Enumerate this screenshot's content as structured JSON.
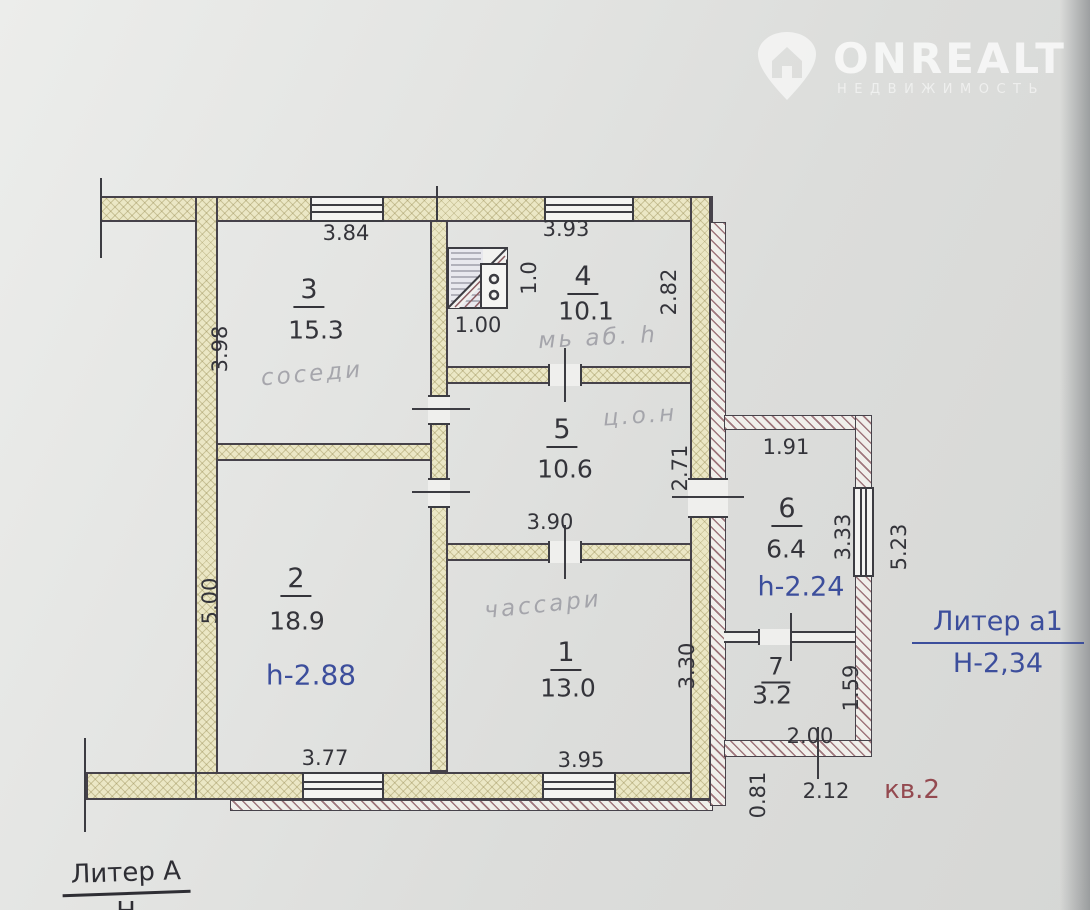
{
  "watermark": {
    "brand": "ONREALT",
    "subtitle": "НЕДВИЖИМОСТЬ"
  },
  "plan": {
    "building_label": "Литер А",
    "building_label_partial": "Н",
    "annex_label": "Литер a1",
    "annex_height": "Н-2,34",
    "apartment_label": "кв.2",
    "rooms": [
      {
        "number": "1",
        "area": "13.0"
      },
      {
        "number": "2",
        "area": "18.9",
        "height": "h-2.88"
      },
      {
        "number": "3",
        "area": "15.3"
      },
      {
        "number": "4",
        "area": "10.1"
      },
      {
        "number": "5",
        "area": "10.6"
      },
      {
        "number": "6",
        "area": "6.4",
        "height": "h-2.24"
      },
      {
        "number": "7",
        "area": "3.2"
      }
    ],
    "dimensions": {
      "d384": "3.84",
      "d393": "3.93",
      "d398": "3.98",
      "d500": "5.00",
      "d282": "2.82",
      "d271": "2.71",
      "d330": "3.30",
      "d10": "1.0",
      "d100": "1.00",
      "d390": "3.90",
      "d377": "3.77",
      "d395": "3.95",
      "d191": "1.91",
      "d333": "3.33",
      "d523": "5.23",
      "d159": "1.59",
      "d200": "2.00",
      "d212": "2.12",
      "d081": "0.81"
    },
    "handwritten": [
      "соседи",
      "мь аб. h",
      "ц.о.н",
      "чассари"
    ],
    "colors": {
      "height_note": "#3c4e9c",
      "apartment_label": "#944a50"
    }
  }
}
